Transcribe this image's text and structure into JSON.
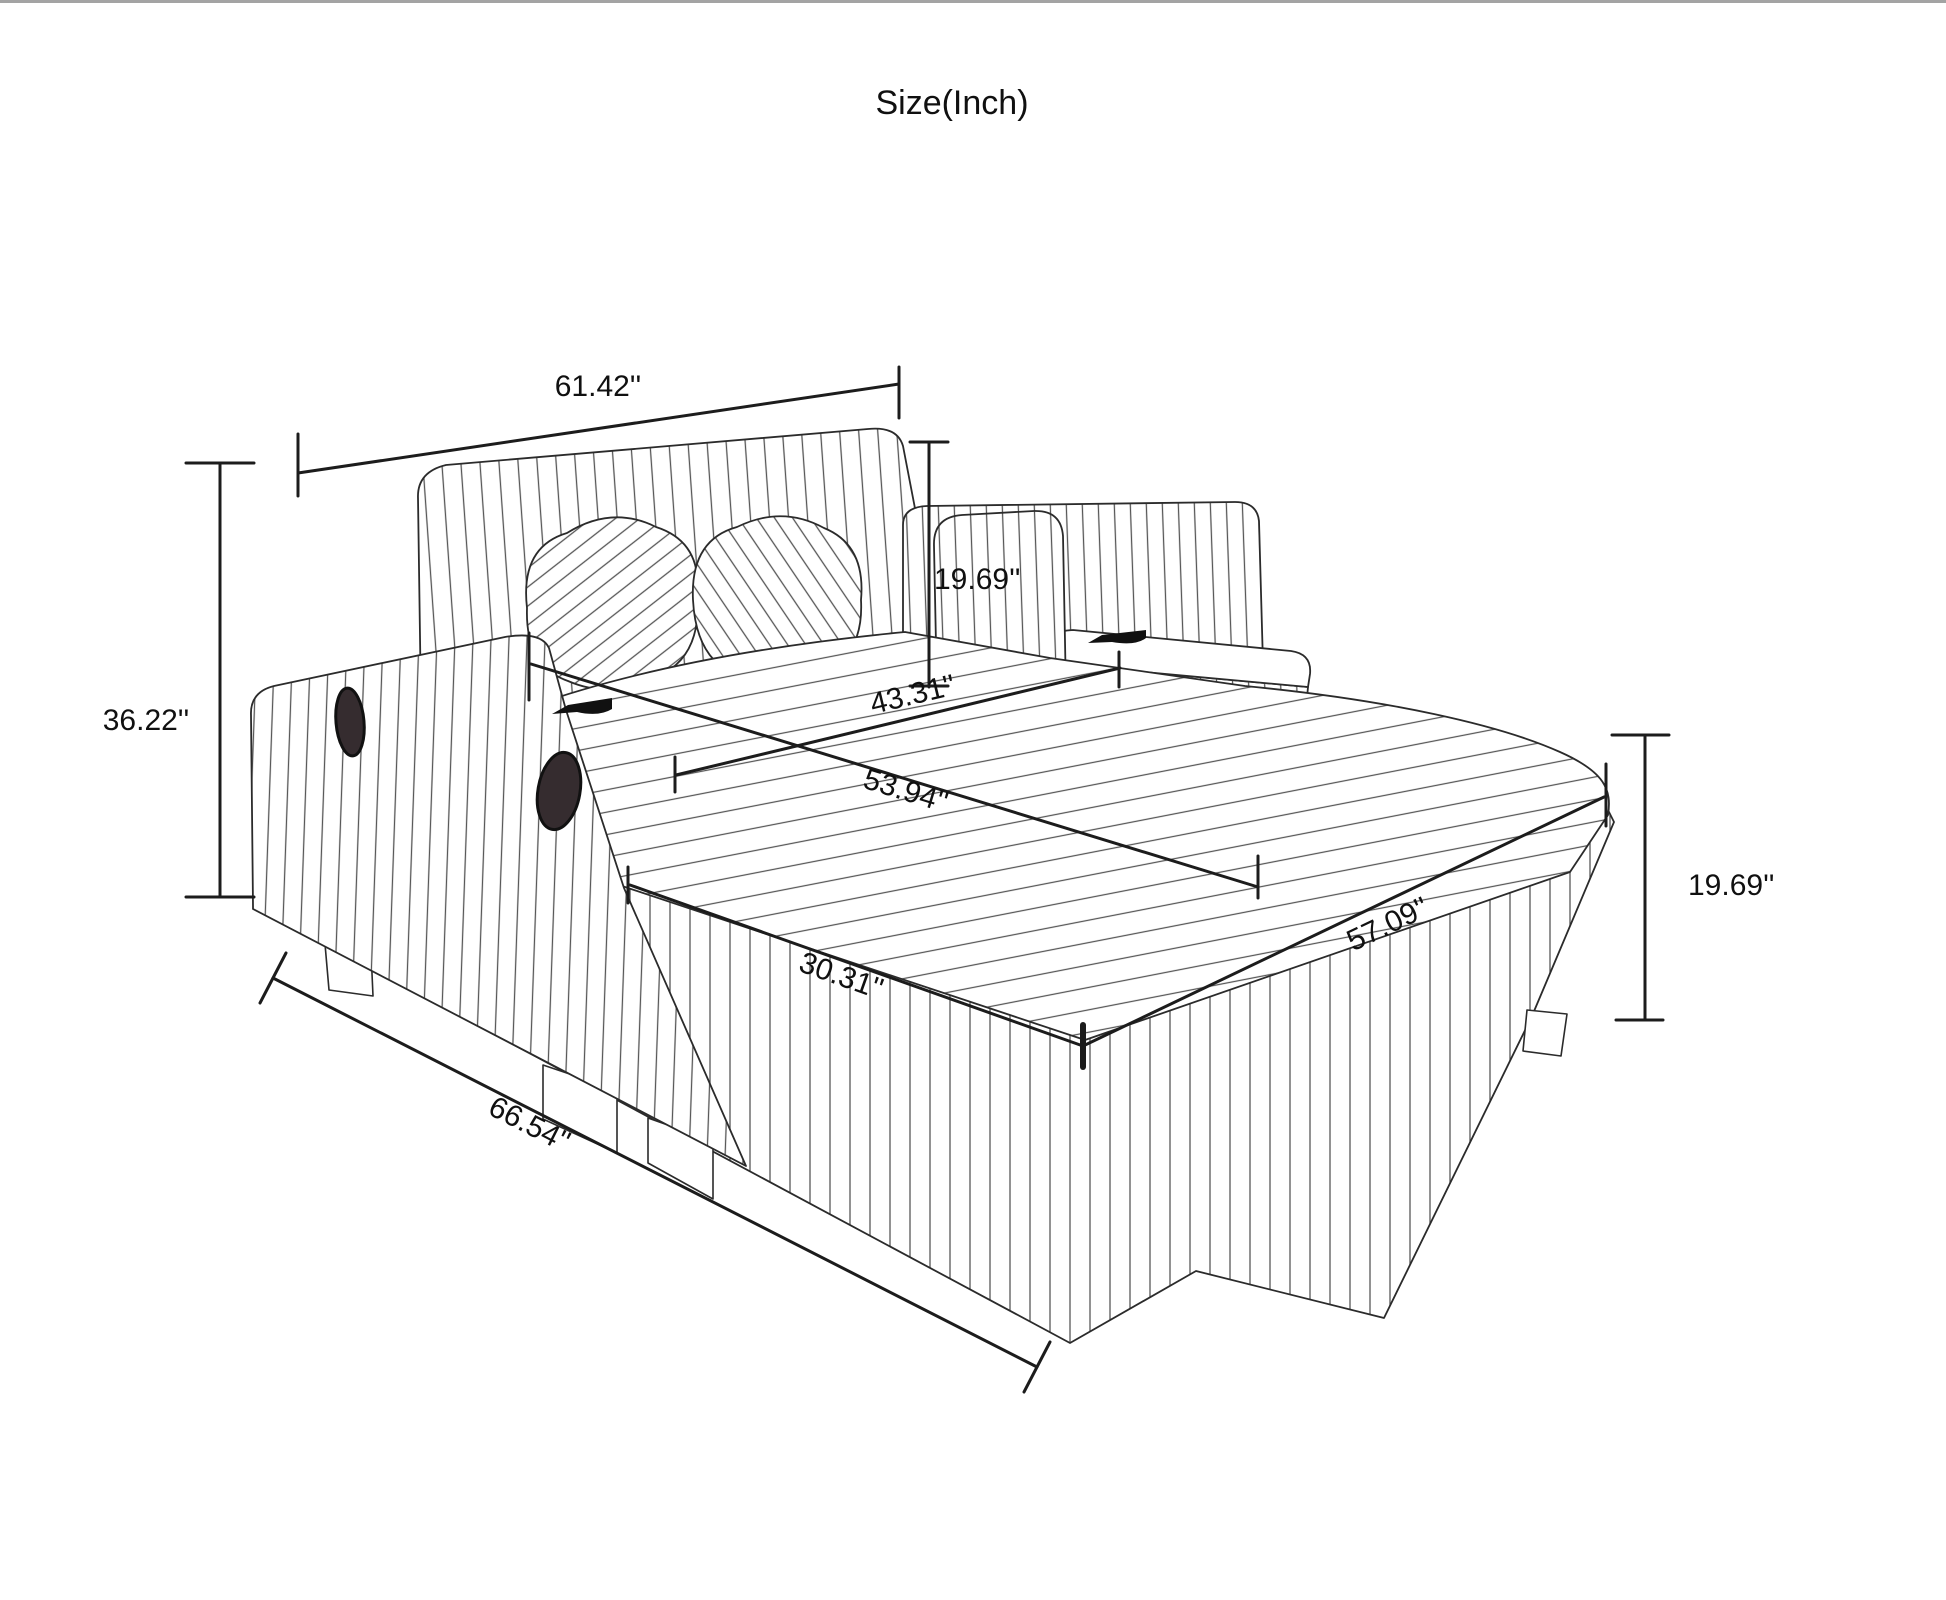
{
  "title": "Size(Inch)",
  "dimensions": {
    "back_top_width": {
      "label": "61.42''",
      "meaning": "backrest top width"
    },
    "overall_height": {
      "label": "36.22''",
      "meaning": "overall height"
    },
    "backrest_cushion_height": {
      "label": "19.69''",
      "meaning": "back cushion height"
    },
    "inner_seat_width": {
      "label": "43.31''",
      "meaning": "inner seat width"
    },
    "seat_diagonal_width": {
      "label": "53.94''",
      "meaning": "seat front width"
    },
    "chaise_seat_width": {
      "label": "30.31''",
      "meaning": "chaise cushion width"
    },
    "chaise_seat_length": {
      "label": "57.09''",
      "meaning": "chaise seat length"
    },
    "seat_base_height": {
      "label": "19.69''",
      "meaning": "base height"
    },
    "overall_front_width": {
      "label": "66.54''",
      "meaning": "overall front width"
    }
  },
  "colors": {
    "background": "#ffffff",
    "top_border": "#a3a3a3",
    "outline": "#2b2b2b",
    "stripe": "#565656",
    "dimension_line": "#1c1c1c",
    "text": "#101010",
    "handle_dark": "#352c2f"
  }
}
